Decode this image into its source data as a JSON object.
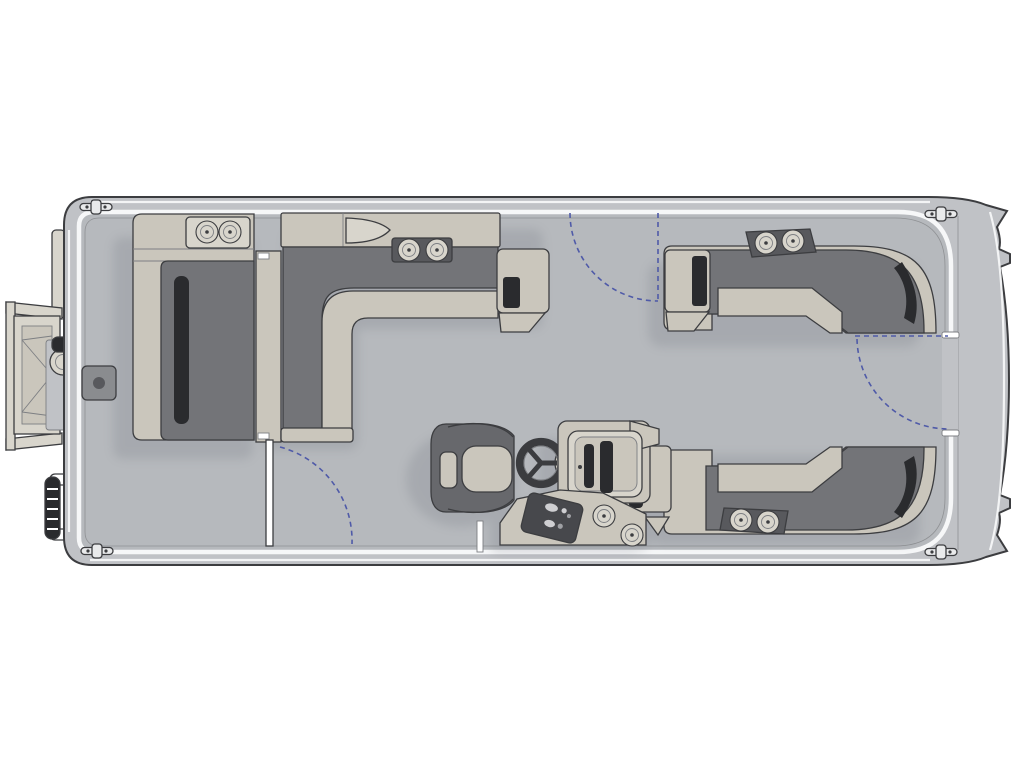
{
  "diagram": {
    "type": "pontoon-boat-floor-plan",
    "view": "top-down",
    "orientation": "bow-left-stern-right"
  },
  "palette": {
    "background": "#ffffff",
    "line": "#3c3d40",
    "line_soft": "#7d7f83",
    "hull": "#c0c2c6",
    "deck": "#b6b9bd",
    "rail_white": "#f6f7f8",
    "hairline": "#8f9194",
    "furn_light": "#cac6bc",
    "furn_light2": "#d8d5cc",
    "furn_dark": "#737478",
    "furn_deep": "#58595d",
    "furn_black": "#2a2b2e",
    "chair": "#67686c",
    "wheel": "#3b3c3f",
    "panel_dark": "#47484c",
    "metal": "#8a8c8f",
    "dash_blue": "#4f5aa8",
    "shadow": "#5c616c",
    "white": "#ffffff"
  },
  "components": [
    {
      "name": "hull",
      "label": "pontoon deck hull"
    },
    {
      "name": "bow-boarding-ramp",
      "label": "bow boarding ramp / front gate"
    },
    {
      "name": "side-boarding-ladder",
      "label": "port bow boarding ladder"
    },
    {
      "name": "bow-lounge",
      "label": "bow port lounge couch"
    },
    {
      "name": "forward-l-bench",
      "label": "forward L-shaped bench"
    },
    {
      "name": "stern-starboard-bench",
      "label": "rear starboard wraparound bench"
    },
    {
      "name": "stern-port-bench",
      "label": "rear port wraparound bench"
    },
    {
      "name": "captain-chair",
      "label": "captain's helm chair"
    },
    {
      "name": "helm-console",
      "label": "helm console with dashboard"
    },
    {
      "name": "steering-wheel",
      "label": "steering wheel"
    },
    {
      "name": "lower-console",
      "label": "lower switch console"
    },
    {
      "name": "bow-gate",
      "label": "port bow entry gate (shown open)"
    },
    {
      "name": "side-gate",
      "label": "starboard side entry gate swing"
    },
    {
      "name": "stern-gate",
      "label": "stern walk-through gate swing"
    },
    {
      "name": "table-base",
      "label": "bow table base mount"
    },
    {
      "name": "mooring-cleat",
      "label": "mooring cleats (4)"
    },
    {
      "name": "cup-holders",
      "label": "cup holder pairs (5)"
    }
  ],
  "counts": {
    "cleats": 4,
    "gates": 3,
    "cup_holder_pairs": 5
  }
}
